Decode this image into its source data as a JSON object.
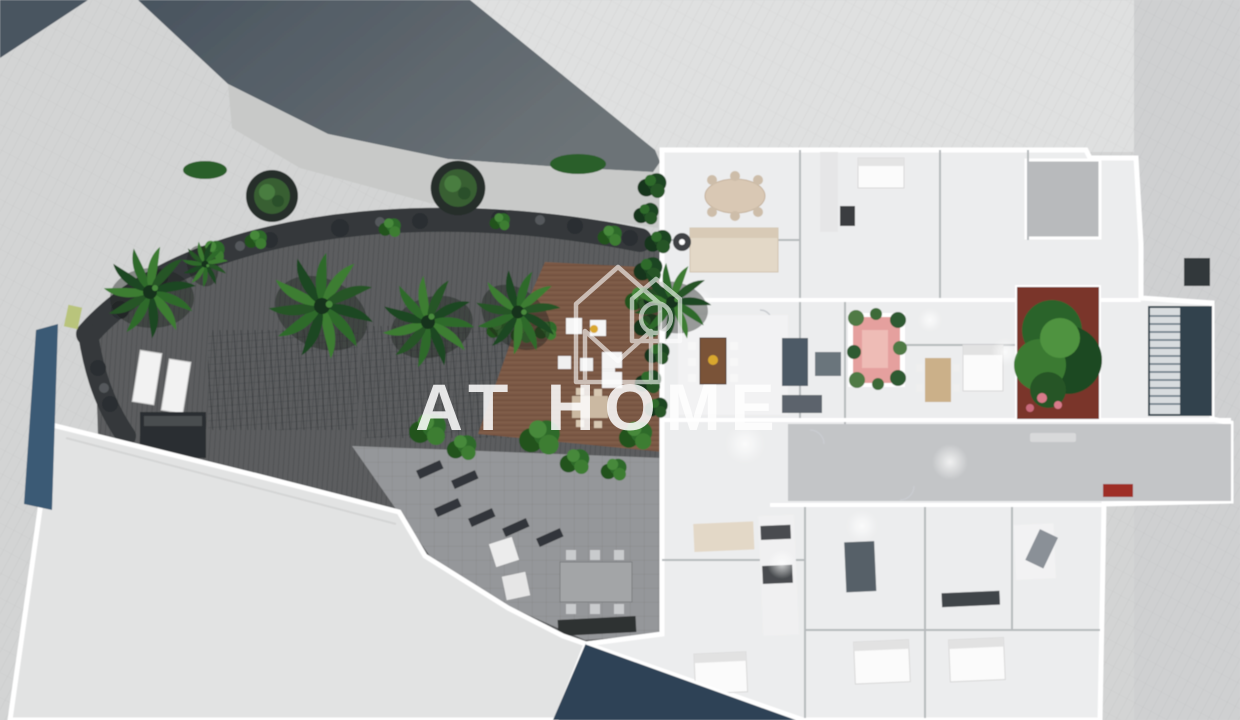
{
  "watermark": {
    "brand": "AT HOME",
    "logo": "house-monogram-logo"
  },
  "colors": {
    "pavement": "#d3d4d4",
    "pavement_light": "#dfe0e0",
    "pavement_right": "#cfd0d1",
    "road_dark": "#4a5560",
    "road": "#55606a",
    "sidewalk": "#c8c9c8",
    "rocks": "#34383a",
    "deck": "#5b5d5f",
    "pavers": "#95979a",
    "wood_deck": "#7c5945",
    "building": "#e2e3e3",
    "plan_floor": "#ecedee",
    "wall_white": "#ffffff",
    "wall_gray": "#b6b9bc",
    "walkway": "#c3c5c7",
    "terrace_gray": "#b8babc",
    "patio_pink": "#e5a09e",
    "planter_red": "#7a352c",
    "flower_pink": "#d87a8a",
    "pool": "#2e4257",
    "lap_pool": "#3b5a74",
    "stairs_dark": "#32434e",
    "stairs_light": "#d8dcdf",
    "sofa_beige": "#e3d8c7",
    "table_wood": "#7a5338",
    "table_tan": "#cbb089",
    "amber": "#d9a72e",
    "accent_red": "#9e2f27",
    "foliage": "#2f6b2c",
    "watermark_white": "#ffffff"
  }
}
